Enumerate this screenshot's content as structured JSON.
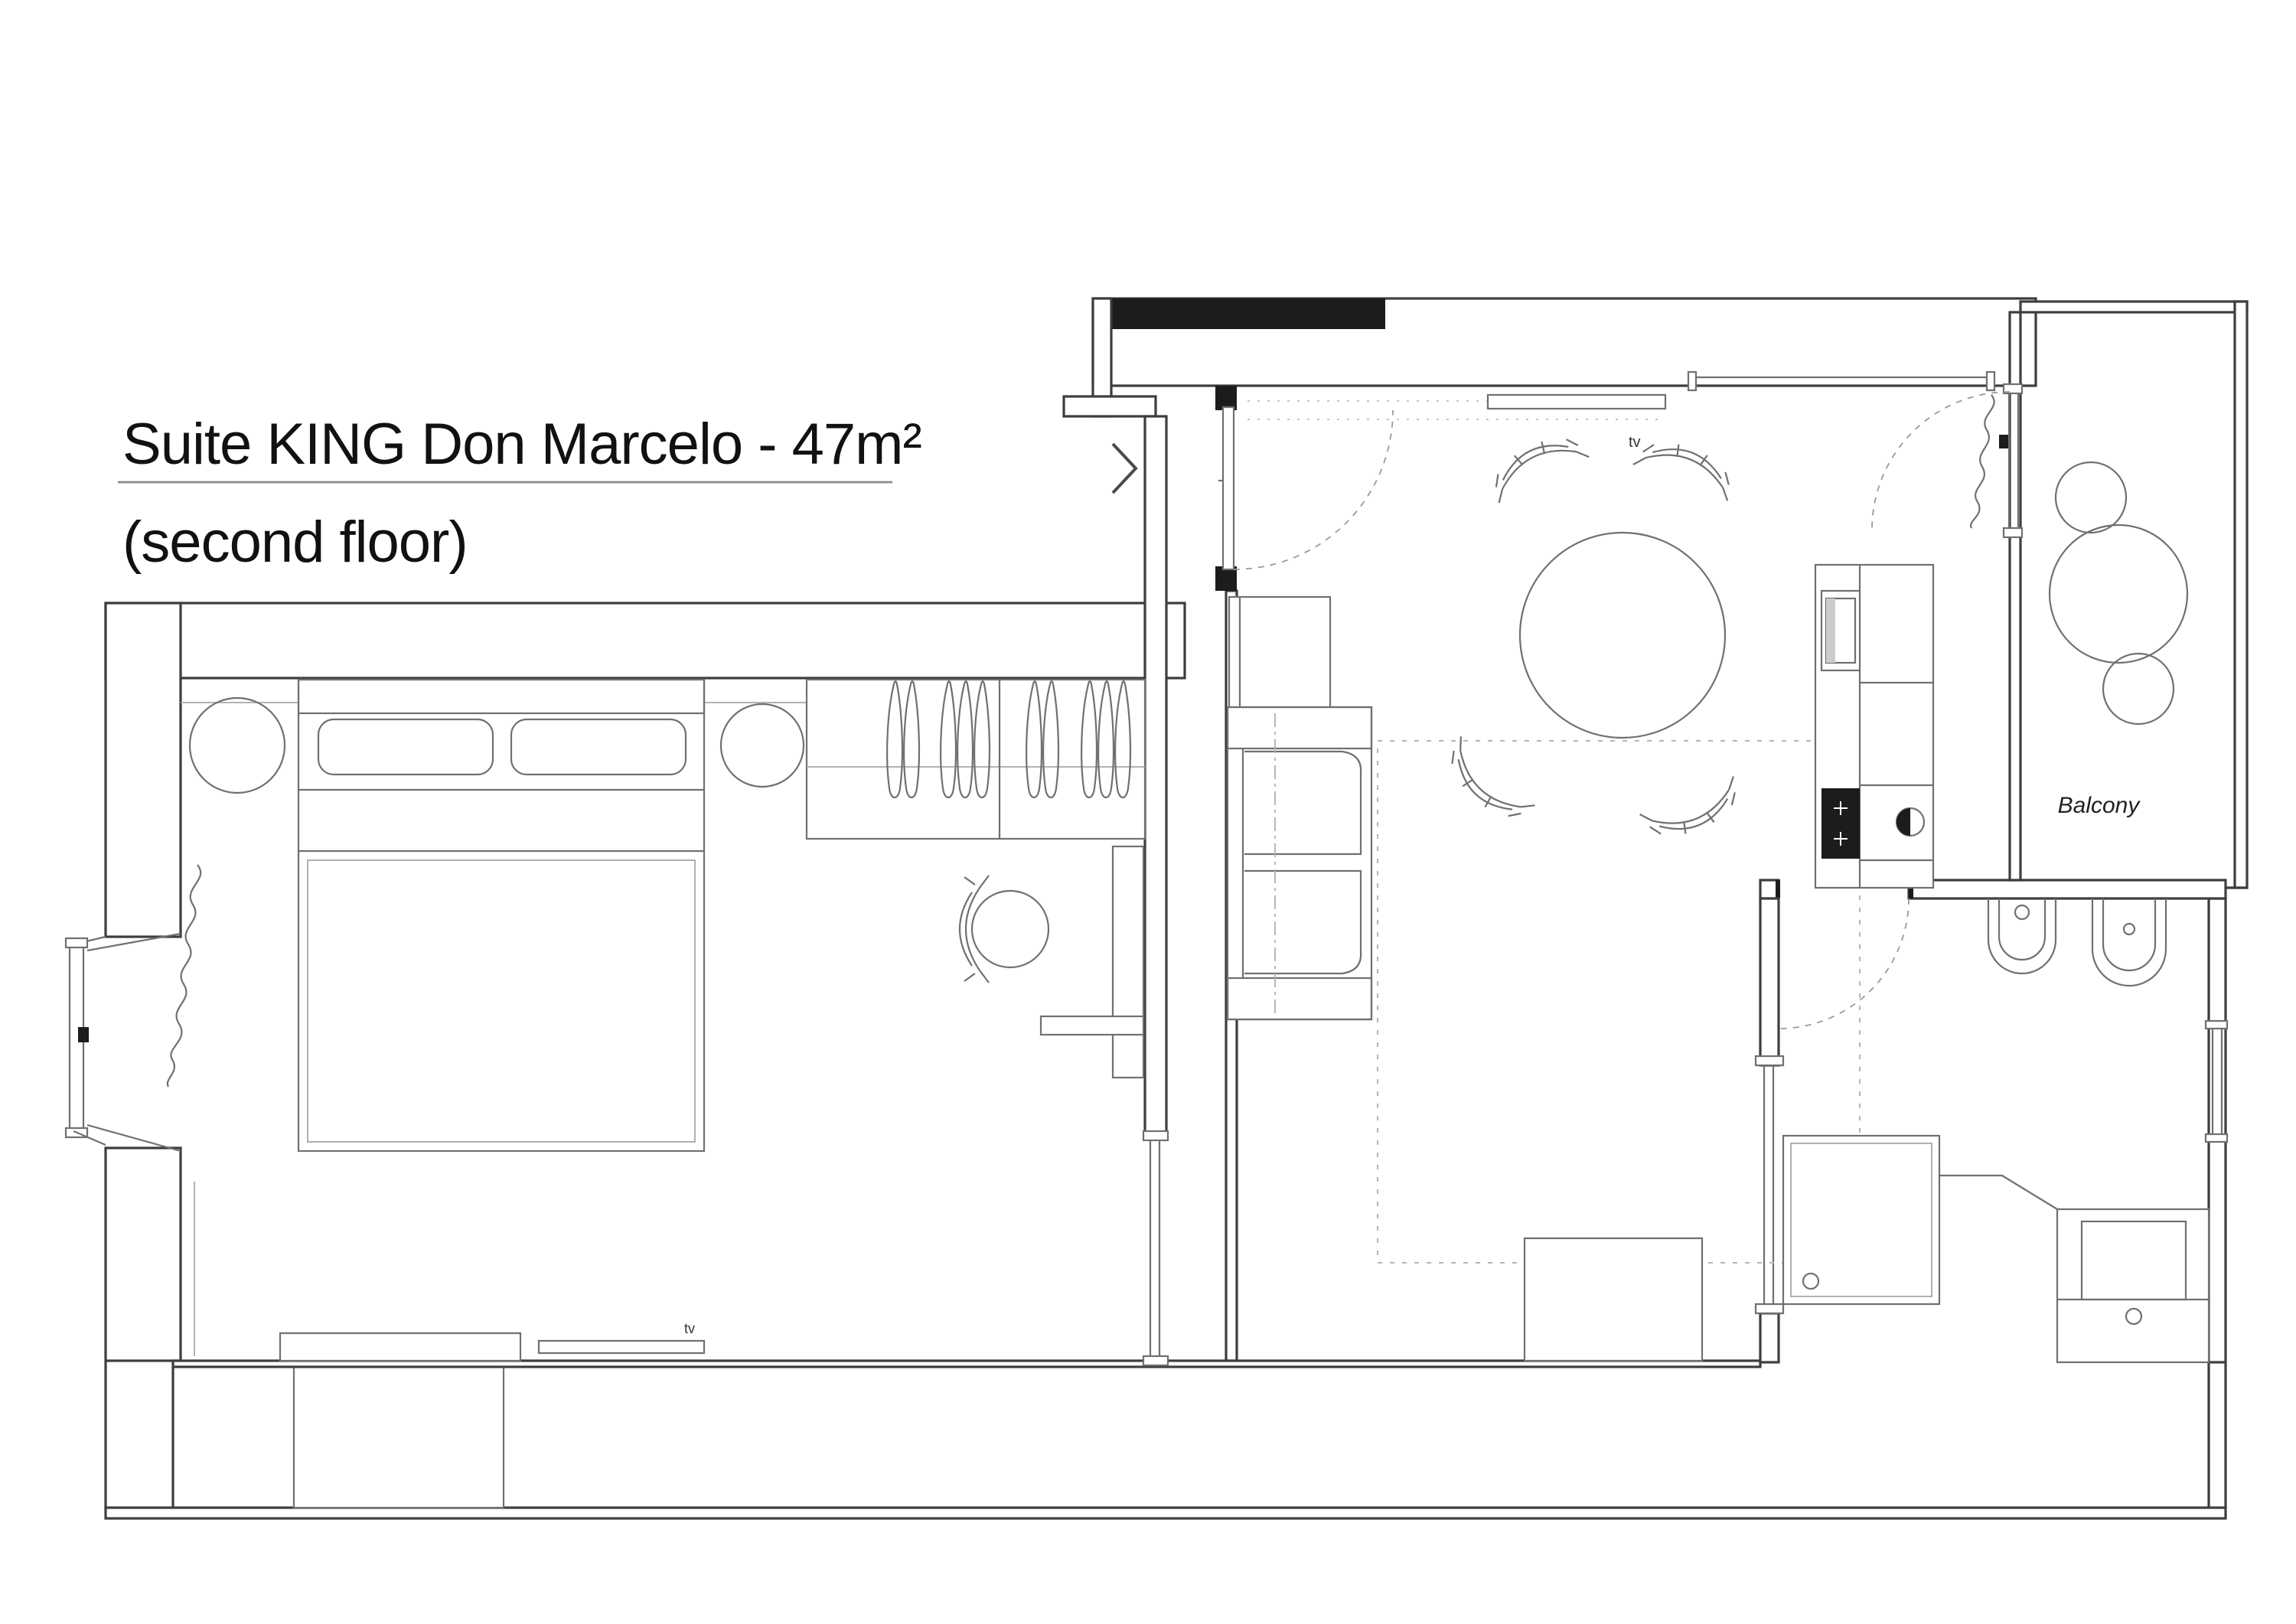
{
  "title": {
    "line1": "Suite KING Don Marcelo - 47m²",
    "line2": "(second floor)",
    "suite_name": "Suite KING Don Marcelo",
    "area": "47m²",
    "floor_note": "second floor"
  },
  "plan": {
    "labels": {
      "balcony": "Balcony",
      "living_room_tv": "tv",
      "bedroom_tv": "tv"
    },
    "colors": {
      "paper": "#ffffff",
      "wall_line": "#3d3d3d",
      "furniture_line": "#707070",
      "light_line": "#a8a8a8",
      "dark_fill": "#1c1c1c",
      "dashed_line": "#9a9a9a"
    }
  }
}
